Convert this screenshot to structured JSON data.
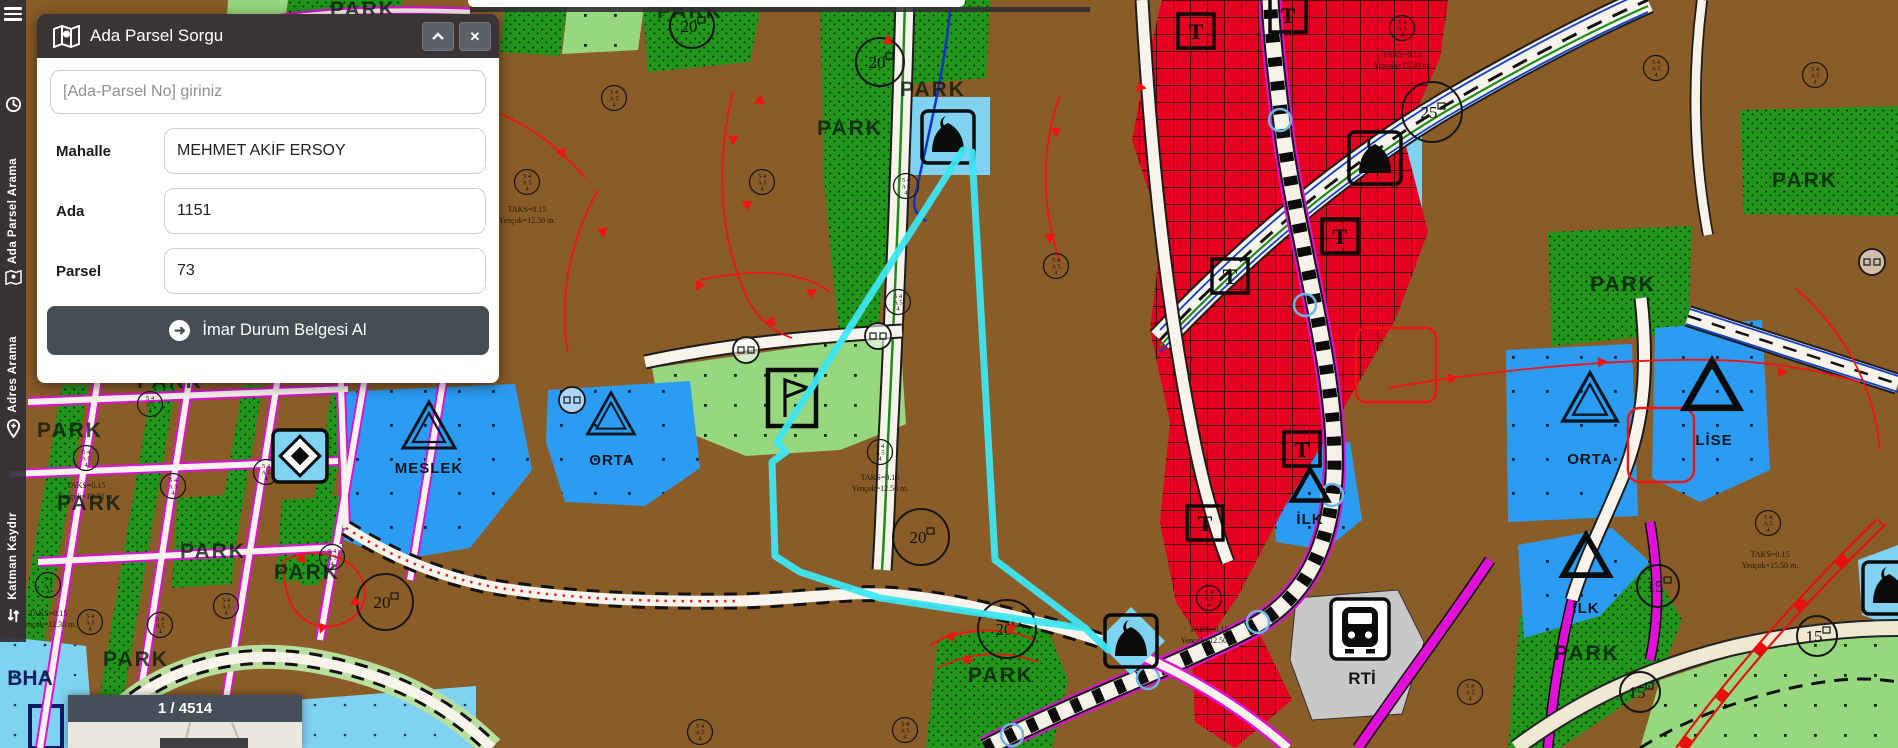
{
  "ui": {
    "topbar": {
      "note": ""
    },
    "sidebar": {
      "menu_icon": "hamburger-icon",
      "items": [
        {
          "icon": "history-icon",
          "label": ""
        },
        {
          "icon": "map-search-icon",
          "label": "Ada Parsel Arama"
        },
        {
          "icon": "location-pin-icon",
          "label": "Adres Arama"
        },
        {
          "icon": "layers-swap-icon",
          "label": "Katman Kaydır"
        }
      ]
    },
    "panel": {
      "title": "Ada Parsel Sorgu",
      "collapse_label": "^",
      "close_label": "✕",
      "search_placeholder": "[Ada-Parsel No] giriniz",
      "fields": [
        {
          "label": "Mahalle",
          "value": "MEHMET AKİF ERSOY"
        },
        {
          "label": "Ada",
          "value": "1151"
        },
        {
          "label": "Parsel",
          "value": "73"
        }
      ],
      "submit_label": "İmar Durum Belgesi Al",
      "submit_icon": "arrow-right-circle-icon"
    },
    "pager": {
      "label": "1 / 4514"
    }
  },
  "map": {
    "colors": {
      "parcel_brown": "#8a5c28",
      "park_green": "#21961b",
      "light_green": "#97d77f",
      "zone_blue": "#2b9cf2",
      "light_blue": "#7fd2f2",
      "commercial_red": "#e50021",
      "selection_cyan": "#3ee6f2",
      "road_magenta": "#e010d8",
      "road_white": "#f8f4ec",
      "ui_dark": "#3a3436",
      "button_slate": "#454d55"
    },
    "area_labels": [
      {
        "t": "PARK",
        "x": 70,
        "y": 437,
        "c": "park"
      },
      {
        "t": "PARK",
        "x": 90,
        "y": 510,
        "c": "park"
      },
      {
        "t": "PARK",
        "x": 213,
        "y": 558,
        "c": "park"
      },
      {
        "t": "PARK",
        "x": 307,
        "y": 579,
        "c": "park"
      },
      {
        "t": "PARK",
        "x": 136,
        "y": 666,
        "c": "park"
      },
      {
        "t": "PARK",
        "x": 170,
        "y": 388,
        "c": "park"
      },
      {
        "t": "PARK",
        "x": 363,
        "y": 16,
        "c": "park"
      },
      {
        "t": "PARK",
        "x": 690,
        "y": 18,
        "c": "park"
      },
      {
        "t": "PARK",
        "x": 850,
        "y": 135,
        "c": "park"
      },
      {
        "t": "PARK",
        "x": 933,
        "y": 96,
        "c": "park"
      },
      {
        "t": "PARK",
        "x": 1623,
        "y": 291,
        "c": "park"
      },
      {
        "t": "PARK",
        "x": 1805,
        "y": 187,
        "c": "park"
      },
      {
        "t": "PARK",
        "x": 1587,
        "y": 660,
        "c": "park"
      },
      {
        "t": "PARK",
        "x": 1001,
        "y": 682,
        "c": "park"
      },
      {
        "t": "ORTA",
        "x": 612,
        "y": 465,
        "c": "school"
      },
      {
        "t": "ORTA",
        "x": 1590,
        "y": 464,
        "c": "school"
      },
      {
        "t": "LİSE",
        "x": 1714,
        "y": 445,
        "c": "school"
      },
      {
        "t": "MESLEK",
        "x": 429,
        "y": 473,
        "c": "school"
      },
      {
        "t": "İLK",
        "x": 1310,
        "y": 524,
        "c": "school"
      },
      {
        "t": "İLK",
        "x": 1586,
        "y": 613,
        "c": "school"
      },
      {
        "t": "BHA",
        "x": 30,
        "y": 685,
        "c": "bha"
      },
      {
        "t": "RTİ",
        "x": 1362,
        "y": 684,
        "c": "rti"
      }
    ],
    "stamp_lines": [
      "5 4",
      "A 5",
      "4"
    ],
    "stamps": [
      [
        527,
        182
      ],
      [
        614,
        98
      ],
      [
        762,
        182
      ],
      [
        906,
        186
      ],
      [
        898,
        302
      ],
      [
        1056,
        266
      ],
      [
        880,
        452
      ],
      [
        1402,
        28
      ],
      [
        1209,
        598
      ],
      [
        1768,
        523
      ],
      [
        905,
        730
      ],
      [
        1470,
        692
      ],
      [
        86,
        458
      ],
      [
        150,
        404
      ],
      [
        173,
        486
      ],
      [
        266,
        472
      ],
      [
        332,
        557
      ],
      [
        48,
        585
      ],
      [
        90,
        622
      ],
      [
        226,
        606
      ],
      [
        700,
        732
      ],
      [
        1656,
        68
      ],
      [
        1815,
        75
      ],
      [
        160,
        625
      ]
    ],
    "note_line1": "TAKS=0.15",
    "notes": [
      {
        "x": 527,
        "y": 212,
        "v": "Yençok=12.50 m."
      },
      {
        "x": 880,
        "y": 480,
        "v": "Yençok=12.50 m."
      },
      {
        "x": 1402,
        "y": 57,
        "v": "Yençok=15.30 m."
      },
      {
        "x": 1770,
        "y": 557,
        "v": "Yençok=15.50 m."
      },
      {
        "x": 1209,
        "y": 632,
        "v": "Yençok=12.50 m."
      },
      {
        "x": 86,
        "y": 488,
        "v": "Yençok=12.30 m."
      },
      {
        "x": 48,
        "y": 616,
        "v": "Yençok=12.30 m."
      }
    ],
    "road_circles": [
      {
        "t": "20",
        "x": 921,
        "y": 537,
        "r": 28
      },
      {
        "t": "20",
        "x": 1007,
        "y": 629,
        "r": 29
      },
      {
        "t": "20",
        "x": 385,
        "y": 602,
        "r": 28
      },
      {
        "t": "20",
        "x": 880,
        "y": 62,
        "r": 24
      },
      {
        "t": "20",
        "x": 692,
        "y": 26,
        "r": 22
      },
      {
        "t": "25",
        "x": 1432,
        "y": 112,
        "r": 30
      },
      {
        "t": "15",
        "x": 1658,
        "y": 586,
        "r": 21
      },
      {
        "t": "15",
        "x": 1640,
        "y": 692,
        "r": 20
      },
      {
        "t": "15",
        "x": 1817,
        "y": 636,
        "r": 20
      }
    ],
    "t_symbol": "T",
    "t_marks": [
      [
        1196,
        30
      ],
      [
        1288,
        14
      ],
      [
        1340,
        235
      ],
      [
        1230,
        275
      ],
      [
        1302,
        448
      ],
      [
        1205,
        522
      ]
    ],
    "mini_circles": [
      [
        746,
        350
      ],
      [
        878,
        336
      ],
      [
        572,
        400
      ],
      [
        1872,
        262
      ]
    ],
    "icons": {
      "mosques": [
        [
          948,
          137
        ],
        [
          1375,
          158
        ],
        [
          1131,
          641
        ],
        [
          1889,
          588
        ]
      ],
      "trains": [
        [
          1360,
          630
        ]
      ],
      "flags": [
        [
          792,
          398
        ]
      ],
      "diamonds": [
        [
          300,
          456
        ]
      ],
      "tri_double": [
        [
          429,
          428,
          1.0
        ],
        [
          611,
          416,
          0.9
        ],
        [
          1590,
          400,
          1.05
        ]
      ],
      "tri_thick": [
        [
          1712,
          388,
          1.1
        ],
        [
          1310,
          487,
          0.75
        ],
        [
          1586,
          558,
          0.95
        ]
      ]
    },
    "red_triangles": [
      [
        760,
        100,
        10
      ],
      [
        747,
        205,
        180
      ],
      [
        772,
        322,
        140
      ],
      [
        812,
        292,
        60
      ],
      [
        1452,
        378,
        80
      ],
      [
        1602,
        362,
        85
      ],
      [
        1782,
        372,
        95
      ],
      [
        302,
        558,
        20
      ],
      [
        356,
        602,
        120
      ],
      [
        322,
        628,
        200
      ],
      [
        952,
        636,
        40
      ],
      [
        1012,
        628,
        70
      ],
      [
        968,
        660,
        100
      ],
      [
        472,
        102,
        50
      ],
      [
        562,
        152,
        40
      ],
      [
        603,
        232,
        170
      ],
      [
        1056,
        132,
        175
      ],
      [
        1050,
        238,
        185
      ],
      [
        700,
        285,
        90
      ],
      [
        888,
        40,
        0
      ],
      [
        1140,
        88,
        220
      ],
      [
        733,
        140,
        185
      ]
    ]
  }
}
